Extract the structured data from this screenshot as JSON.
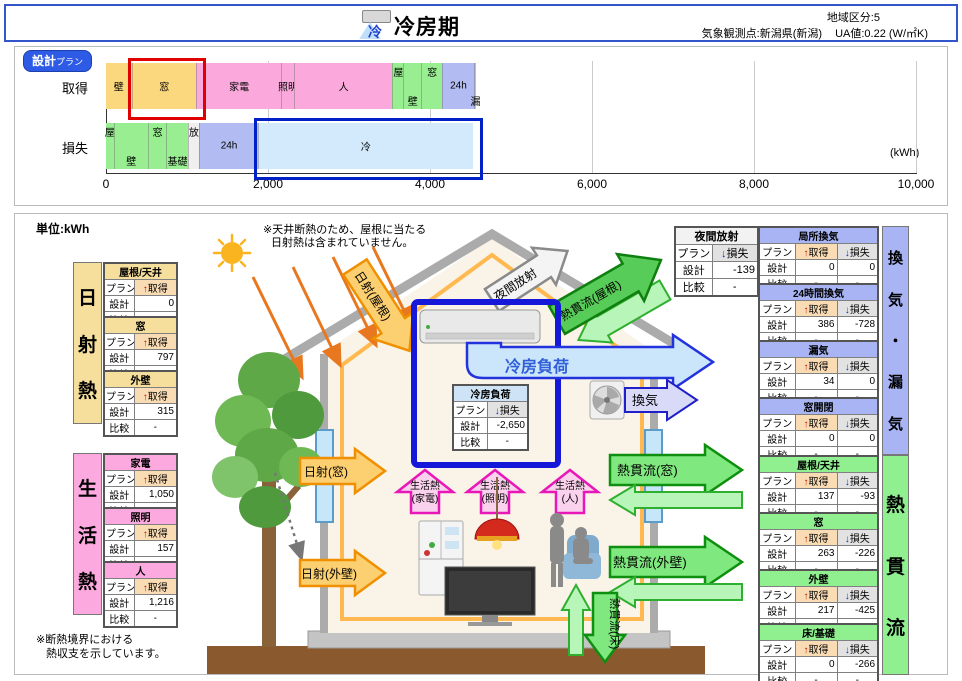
{
  "header": {
    "title": "冷房期",
    "icon_char": "冷",
    "region": "地域区分:5",
    "station": "気象観測点:新潟県(新潟)",
    "ua": "UA値:0.22 (W/㎡K)"
  },
  "chart_data": {
    "type": "bar",
    "orientation": "horizontal-stacked",
    "badge_main": "設計",
    "badge_sub": "プラン",
    "unit": "(kWh)",
    "xlim": [
      0,
      10000
    ],
    "ticks": [
      0,
      2000,
      4000,
      6000,
      8000,
      10000
    ],
    "tick_labels": [
      "0",
      "2,000",
      "4,000",
      "6,000",
      "8,000",
      "10,000"
    ],
    "group_colors": {
      "solar": "#FBD77E",
      "living": "#FBA9DC",
      "trans": "#98EE90",
      "vent": "#B3BCF2",
      "rad": "#EFEFEF",
      "cool": "#D2EAFB"
    },
    "rows": [
      {
        "label": "取得",
        "segments": [
          {
            "name": "壁",
            "value": 315,
            "group": "solar",
            "pos": "mid"
          },
          {
            "name": "窓",
            "value": 797,
            "group": "solar",
            "pos": "mid"
          },
          {
            "name": "家電",
            "value": 1050,
            "group": "living",
            "pos": "mid"
          },
          {
            "name": "照明",
            "value": 157,
            "group": "living",
            "pos": "mid"
          },
          {
            "name": "人",
            "value": 1216,
            "group": "living",
            "pos": "mid"
          },
          {
            "name": "屋",
            "value": 137,
            "group": "trans",
            "pos": "top"
          },
          {
            "name": "壁",
            "value": 217,
            "group": "trans",
            "pos": "bottom"
          },
          {
            "name": "窓",
            "value": 263,
            "group": "trans",
            "pos": "top"
          },
          {
            "name": "24h",
            "value": 386,
            "group": "vent",
            "pos": "mid"
          },
          {
            "name": "漏",
            "value": 34,
            "group": "vent",
            "pos": "bottom"
          }
        ]
      },
      {
        "label": "損失",
        "segments": [
          {
            "name": "屋",
            "value": 93,
            "group": "trans",
            "pos": "top"
          },
          {
            "name": "壁",
            "value": 425,
            "group": "trans",
            "pos": "bottom"
          },
          {
            "name": "窓",
            "value": 226,
            "group": "trans",
            "pos": "top"
          },
          {
            "name": "基礎",
            "value": 266,
            "group": "trans",
            "pos": "bottom"
          },
          {
            "name": "放",
            "value": 139,
            "group": "rad",
            "pos": "top"
          },
          {
            "name": "24h",
            "value": 728,
            "group": "vent",
            "pos": "mid"
          },
          {
            "name": "冷",
            "value": 2650,
            "group": "cool",
            "pos": "mid"
          }
        ]
      }
    ],
    "highlights": [
      {
        "row": 0,
        "seg": 1,
        "color": "#E00000"
      },
      {
        "row": 1,
        "seg": 6,
        "color": "#0020C8"
      }
    ]
  },
  "table_labels": {
    "plan": "プラン",
    "design": "設計",
    "compare": "比較",
    "gain_arrow": "↑",
    "gain": "取得",
    "loss_arrow": "↓",
    "loss": "損失",
    "dash": "-"
  },
  "left_sections": [
    {
      "label": "日射熱",
      "color": "#F6DE9C",
      "tables": [
        {
          "name": "屋根/天井",
          "gain": "0"
        },
        {
          "name": "窓",
          "gain": "797"
        },
        {
          "name": "外壁",
          "gain": "315"
        }
      ]
    },
    {
      "label": "生活熱",
      "color": "#FBA9DE",
      "tables": [
        {
          "name": "家電",
          "gain": "1,050"
        },
        {
          "name": "照明",
          "gain": "157"
        },
        {
          "name": "人",
          "gain": "1,216"
        }
      ]
    }
  ],
  "right_sections": [
    {
      "label": "換気・漏気",
      "color": "#A8B4F4",
      "tables": [
        {
          "name": "局所換気",
          "gain": "0",
          "loss": "0"
        },
        {
          "name": "24時間換気",
          "gain": "386",
          "loss": "-728"
        },
        {
          "name": "漏気",
          "gain": "34",
          "loss": "0"
        },
        {
          "name": "窓開閉",
          "gain": "0",
          "loss": "0"
        }
      ]
    },
    {
      "label": "熱貫流",
      "color": "#90F090",
      "tables": [
        {
          "name": "屋根/天井",
          "gain": "137",
          "loss": "-93"
        },
        {
          "name": "窓",
          "gain": "263",
          "loss": "-226"
        },
        {
          "name": "外壁",
          "gain": "217",
          "loss": "-425"
        },
        {
          "name": "床/基礎",
          "gain": "0",
          "loss": "-266"
        }
      ]
    }
  ],
  "center_tables": [
    {
      "title": "夜間放射",
      "value": "-139",
      "color": "#F2F2F2"
    },
    {
      "title": "冷房負荷",
      "value": "-2,650",
      "color": "#CFE3F6"
    }
  ],
  "diagram": {
    "note_line1": "※天井断熱のため、屋根に当たる",
    "note_line2": "日射熱は含まれていません。",
    "solar_roof": "日射(屋根)",
    "night_radiation": "夜間放射",
    "trans_roof": "熱貫流(屋根)",
    "cooling_load": "冷房負荷",
    "vent": "換気",
    "trans_window": "熱貫流(窓)",
    "trans_wall": "熱貫流(外壁)",
    "trans_floor": "熱貫流(床)",
    "solar_window": "日射(窓)",
    "solar_wall": "日射(外壁)",
    "living_main": "生活熱",
    "living_sub1": "(家電)",
    "living_sub2": "(照明)",
    "living_sub3": "(人)"
  },
  "notes": {
    "unit": "単位:kWh",
    "boundary1": "※断熱境界における",
    "boundary2": "熱収支を示しています。"
  }
}
